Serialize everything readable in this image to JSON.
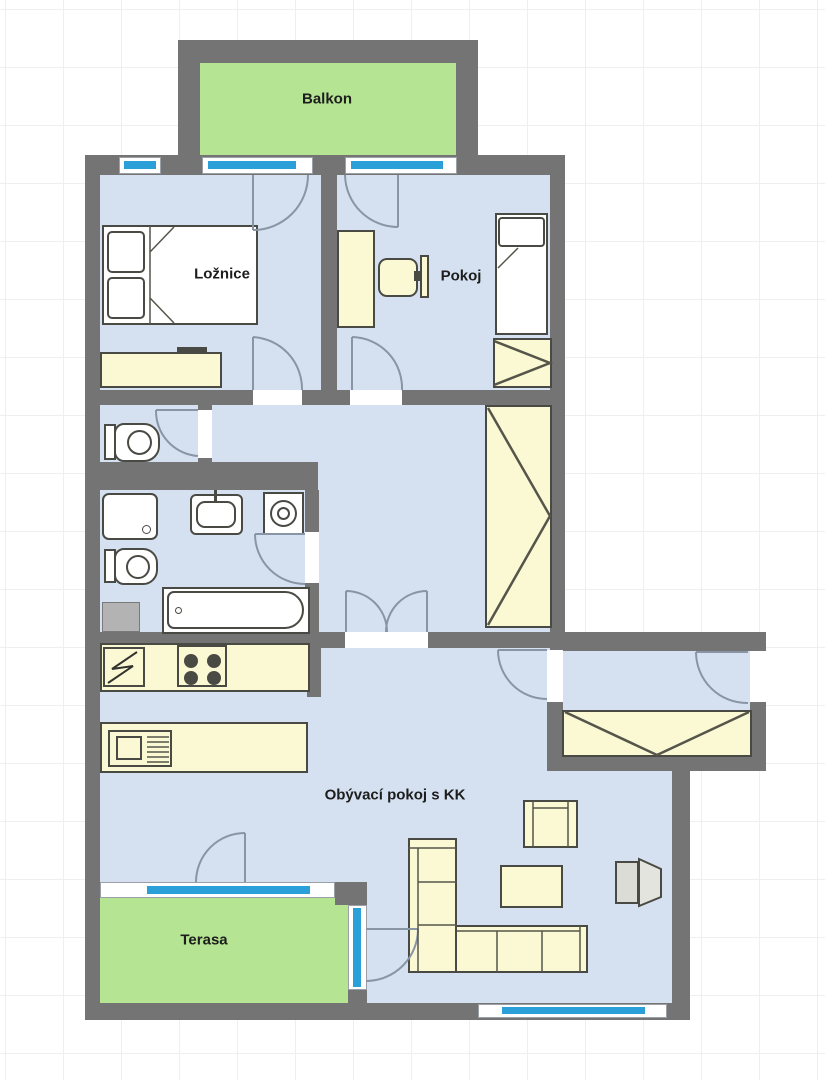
{
  "floorplan": {
    "rooms": [
      {
        "id": "balkon",
        "label": "Balkon"
      },
      {
        "id": "loznice",
        "label": "Ložnice"
      },
      {
        "id": "pokoj",
        "label": "Pokoj"
      },
      {
        "id": "obyvaci_pokoj",
        "label": "Obývací pokoj s KK"
      },
      {
        "id": "terasa",
        "label": "Terasa"
      }
    ],
    "colors": {
      "wall": "#747474",
      "room_floor": "#d5e1f0",
      "outdoor_floor": "#b5e593",
      "furniture_fill": "#fbf8d4",
      "window_glass": "#2b9fd8",
      "fixture_outline": "#4a4a44",
      "door_swing": "#8795a5",
      "label_text": "#1d1d1d",
      "grid_line": "#f1efee",
      "background": "#ffffff"
    },
    "furniture_icons": [
      "double-bed-icon",
      "dresser-icon",
      "desk-icon",
      "office-chair-icon",
      "monitor-icon",
      "single-bed-icon",
      "wardrobe-icon",
      "toilet-icon",
      "shower-icon",
      "washbasin-icon",
      "washing-machine-icon",
      "bathtub-icon",
      "shaft-icon",
      "fridge-icon",
      "cooktop-icon",
      "kitchen-counter-icon",
      "sofa-icon",
      "armchair-icon",
      "coffee-table-icon",
      "tv-icon",
      "window-icon",
      "door-swing-icon"
    ]
  }
}
